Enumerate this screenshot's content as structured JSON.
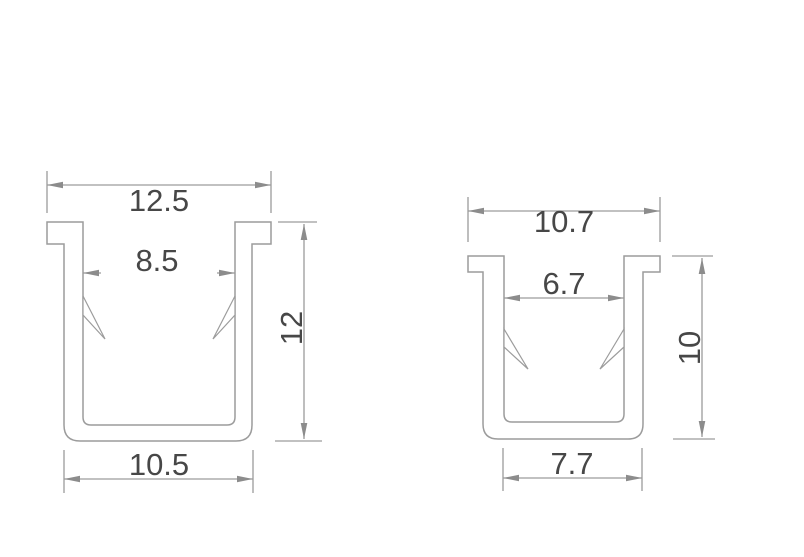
{
  "drawing": {
    "type": "technical-cross-section",
    "background": "#ffffff",
    "colors": {
      "line": "#9c9c9c",
      "arrow": "#8c8c8c",
      "text": "#474747"
    },
    "profiles": [
      {
        "label": "left-u-channel",
        "top_width": "12.5",
        "inner_width": "8.5",
        "height": "12",
        "bottom_width": "10.5"
      },
      {
        "label": "right-u-channel",
        "top_width": "10.7",
        "inner_width": "6.7",
        "height": "10",
        "bottom_width": "7.7"
      }
    ]
  }
}
